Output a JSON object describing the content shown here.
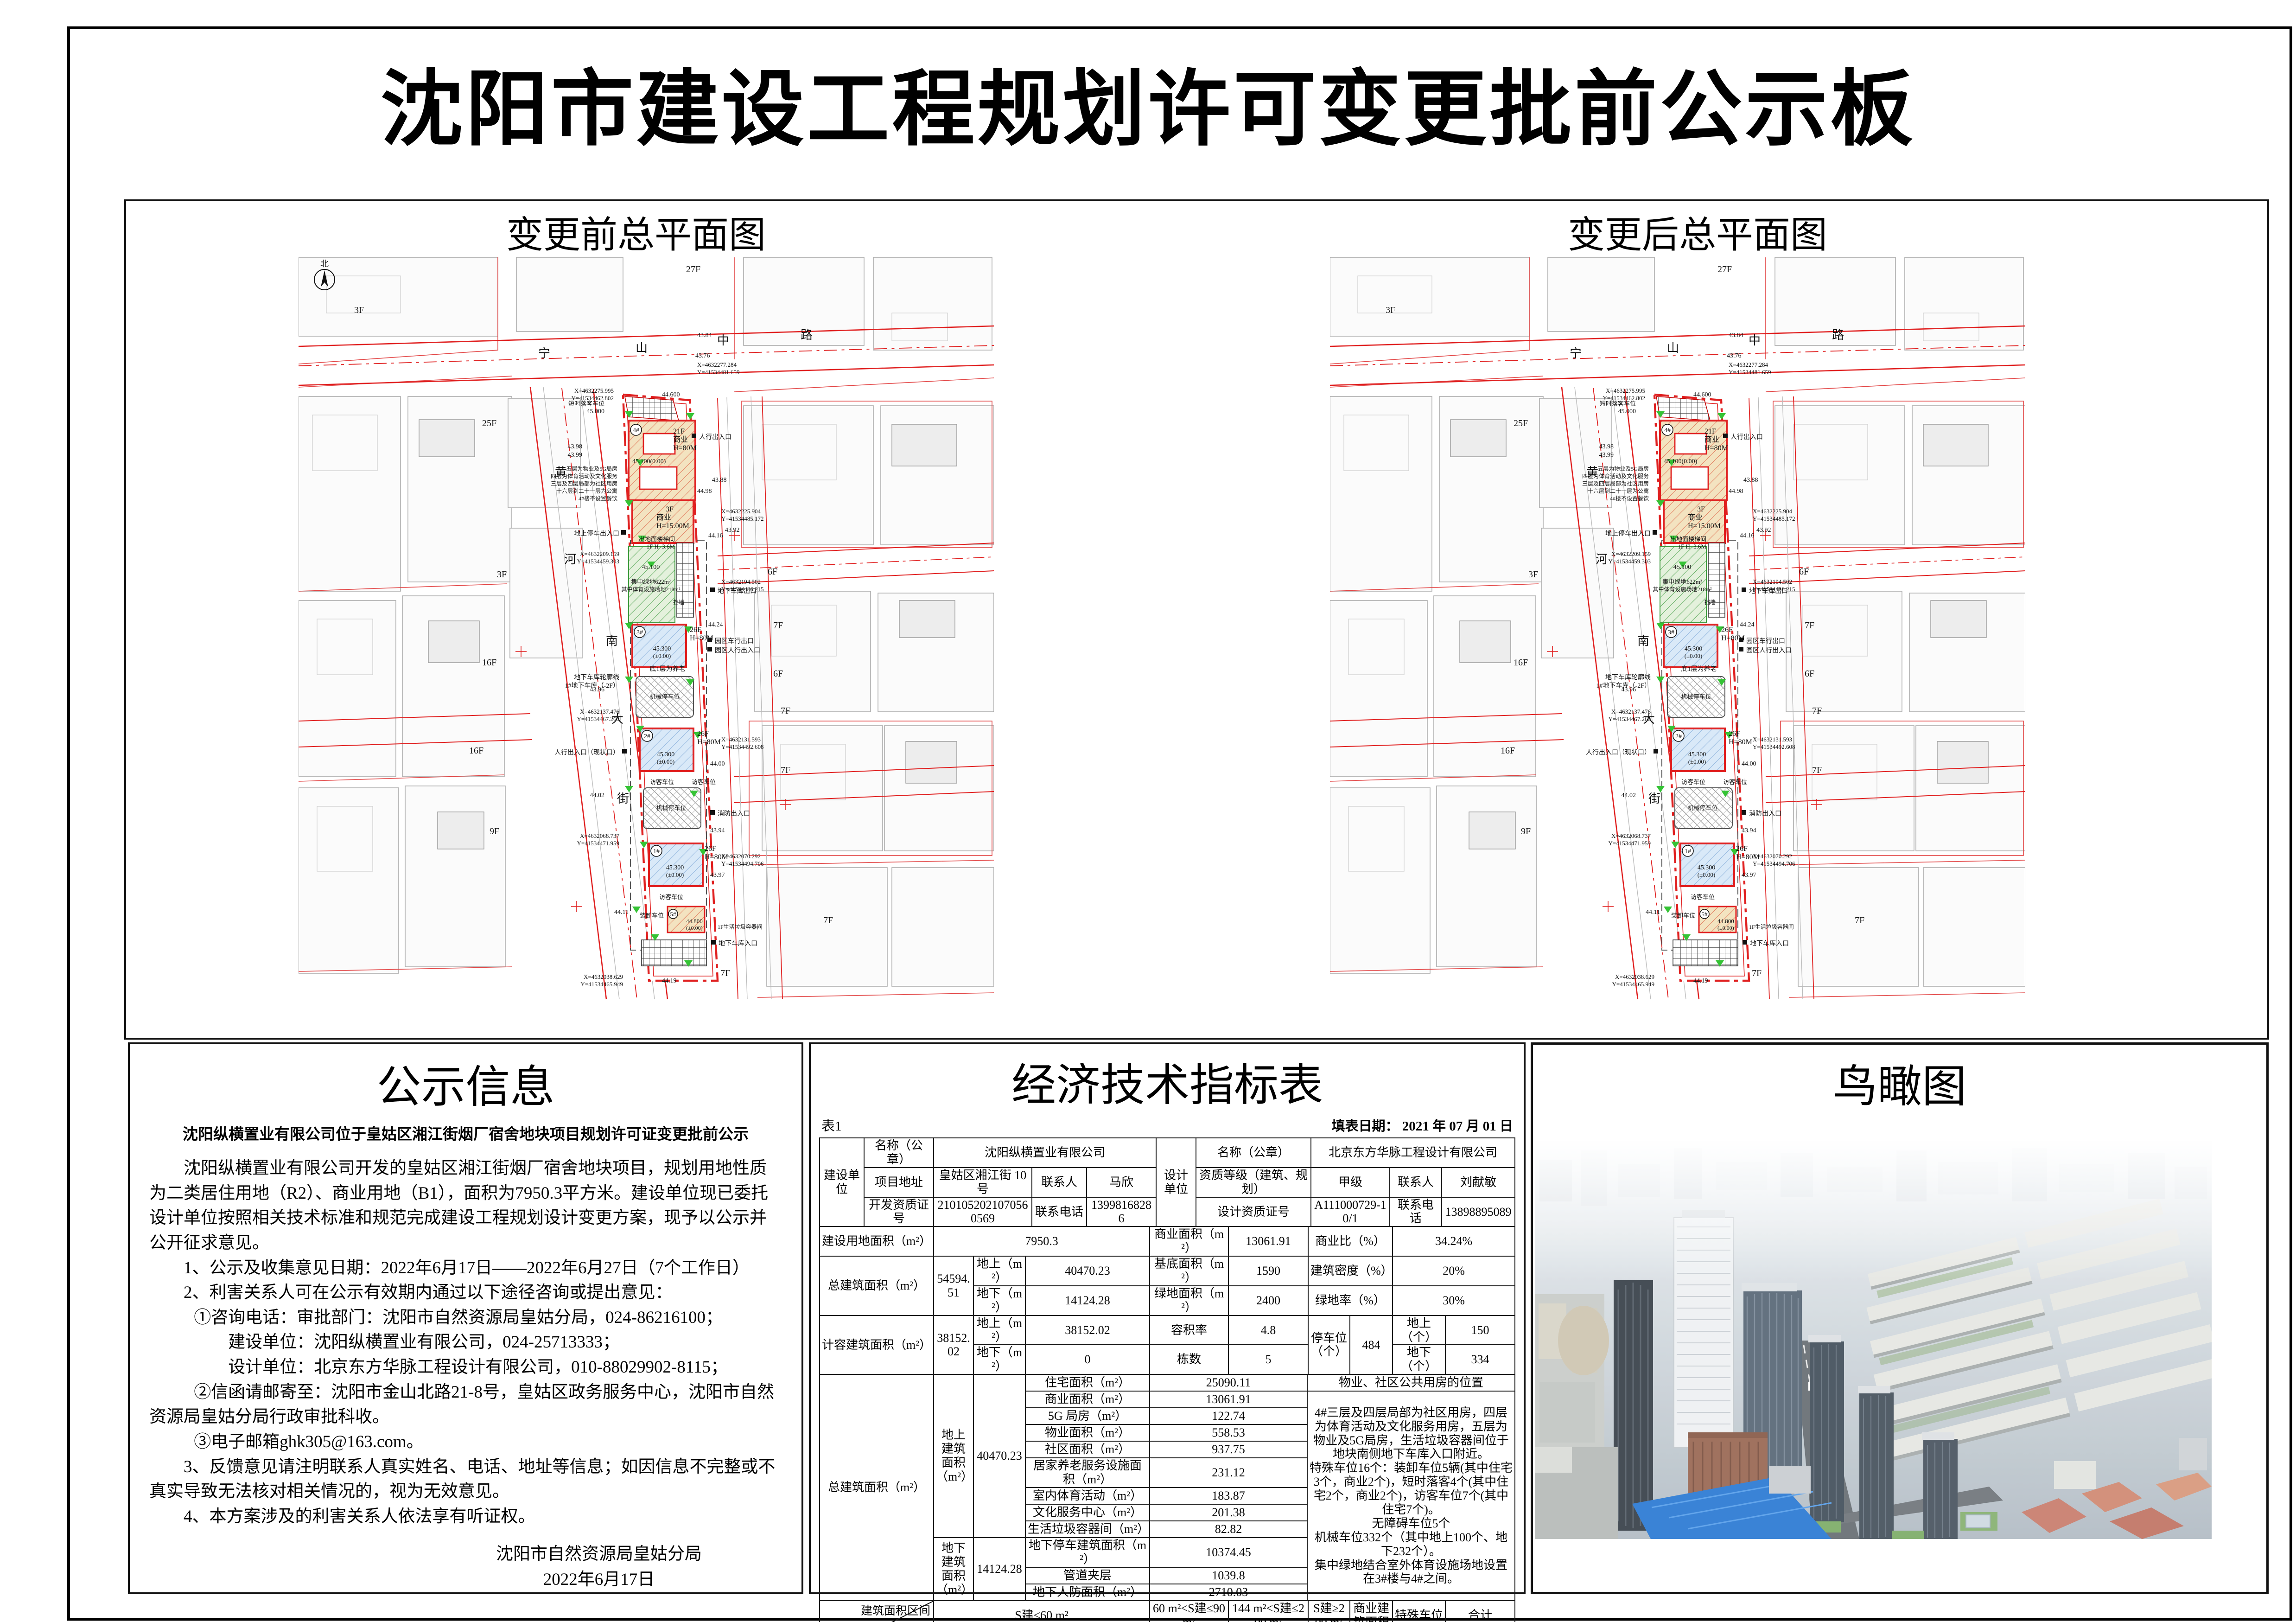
{
  "page": {
    "title": "沈阳市建设工程规划许可变更批前公示板"
  },
  "colors": {
    "boundary_red": "#e02020",
    "parcel_gray": "#adadad",
    "green_marker": "#35c335",
    "commercial_tan": "#f3e3c0",
    "residential_blue": "#d9e9f8",
    "greenspace": "#e4f1dc"
  },
  "plan": {
    "before_label": "变更前总平面图",
    "after_label": "变更后总平面图",
    "north": "北",
    "street_top": [
      "宁",
      "山",
      "中",
      "路"
    ],
    "street_left": [
      "黄",
      "河",
      "南",
      "大",
      "街"
    ],
    "floors": {
      "f27": "27F",
      "f25": "25F",
      "f3": "3F",
      "f16": "16F",
      "f9": "9F",
      "f6": "6F",
      "f7": "7F"
    },
    "b4_no": "4#",
    "b4_l1": "21F",
    "b4_l2": "商业",
    "b4_l3": "H=80M",
    "b4_lvl": "45.100(0.00)",
    "b3f_l1": "3F",
    "b3f_l2": "商业",
    "b3f_l3": "H=15.00M",
    "stair": "出地面楼梯间",
    "stair2": "1F H=3.6M",
    "green1": "集中绿地622m²",
    "green2": "其中体育设施场地218m²",
    "wall": "挡墙",
    "t3_no": "3#",
    "t2_no": "2#",
    "t1_no": "1#",
    "b5_no": "5#",
    "t26": "26F",
    "h80": "H=80M",
    "lvl453": "45.300",
    "pm0": "(±0.00)",
    "elder": "底1层为养老",
    "b5_lvl": "44.800",
    "b5_use": "1F生活垃圾容器间",
    "park": "机械停车位",
    "visitor": "访客车位",
    "drop": "短时落客车位",
    "unload": "装卸车位",
    "ped": "人行出入口",
    "ped2": "人行出入口（现状口）",
    "car_out": "地下车库出口",
    "car_in": "地下车库入口",
    "gate_car": "园区车行出口",
    "gate_ped": "园区人行出入口",
    "fire": "消防出入口",
    "ground_park": "地上停车出入口",
    "ug1": "地下车库轮廓线",
    "ug2": "1#地下车库（-2F）",
    "notes": [
      "五层为物业及5G局房",
      "四层为体育活动及文化服务",
      "三层及四层局部为社区用房",
      "十六层到二十一层为公寓",
      "4#楼不设置餐饮"
    ],
    "coords": [
      "X=4632275.995",
      "Y=41534462.802",
      "X=4632277.284",
      "Y=41534481.659",
      "X=4632225.904",
      "Y=41534485.172",
      "X=4632209.159",
      "Y=41534459.303",
      "X=4632194.502",
      "Y=41534486.215",
      "X=4632137.476",
      "Y=41534467.260",
      "X=4632131.593",
      "Y=41534492.608",
      "X=4632068.737",
      "Y=41534471.959",
      "X=4632070.292",
      "Y=41534494.706",
      "X=4632038.629",
      "Y=41534465.949"
    ],
    "elevs": [
      "44.600",
      "45.000",
      "43.98",
      "43.88",
      "44.98",
      "44.16",
      "45.100",
      "44.24",
      "43.96",
      "45.300",
      "44.00",
      "44.02",
      "43.94",
      "43.97",
      "44.11",
      "44.19",
      "43.84",
      "43.76",
      "43.92",
      "43.99"
    ]
  },
  "notice": {
    "title": "公示信息",
    "subtitle": "沈阳纵横置业有限公司位于皇姑区湘江街烟厂宿舍地块项目规划许可证变更批前公示",
    "para1": "沈阳纵横置业有限公司开发的皇姑区湘江街烟厂宿舍地块项目，规划用地性质为二类居住用地（R2）、商业用地（B1），面积为7950.3平方米。建设单位现已委托设计单位按照相关技术标准和规范完成建设工程规划设计变更方案，现予以公示并公开征求意见。",
    "item1": "1、公示及收集意见日期：2022年6月17日——2022年6月27日（7个工作日）",
    "item2": "2、利害关系人可在公示有效期内通过以下途径咨询或提出意见：",
    "item2a": "①咨询电话：审批部门：沈阳市自然资源局皇姑分局，024-86216100；",
    "item2b": "建设单位：沈阳纵横置业有限公司，024-25713333；",
    "item2c": "设计单位：北京东方华脉工程设计有限公司，010-88029902-8115；",
    "item2d": "②信函请邮寄至：沈阳市金山北路21-8号，皇姑区政务服务中心，沈阳市自然资源局皇姑分局行政审批科收。",
    "item2e": "③电子邮箱ghk305@163.com。",
    "item3": "3、反馈意见请注明联系人真实姓名、电话、地址等信息；如因信息不完整或不真实导致无法核对相关情况的，视为无效意见。",
    "item4": "4、本方案涉及的利害关系人依法享有听证权。",
    "sign1": "沈阳市自然资源局皇姑分局",
    "sign2": "2022年6月17日"
  },
  "table": {
    "title": "经济技术指标表",
    "tag": "表1",
    "date_label": "填表日期：  2021 年 07 月 01 日",
    "builder": {
      "role": "建设单位",
      "name_label": "名称（公章）",
      "name": "沈阳纵横置业有限公司",
      "addr_label": "项目地址",
      "addr": "皇姑区湘江街 10 号",
      "contact_label": "联系人",
      "contact": "马欣",
      "cert_label": "开发资质证号",
      "cert": "2101052021070560569",
      "phone_label": "联系电话",
      "phone": "13998168286"
    },
    "designer": {
      "role": "设计单位",
      "name_label": "名称（公章）",
      "name": "北京东方华脉工程设计有限公司",
      "grade_label": "资质等级（建筑、规划）",
      "grade": "甲级",
      "contact_label": "联系人",
      "contact": "刘献敏",
      "cert_label": "设计资质证号",
      "cert": "A111000729-10/1",
      "phone_label": "联系电话",
      "phone": "13898895089"
    },
    "metrics": {
      "land_label": "建设用地面积（m²）",
      "land": "7950.3",
      "biz_label": "商业面积（m²）",
      "biz": "13061.91",
      "bizratio_label": "商业比（%）",
      "bizratio": "34.24%",
      "total_label": "总建筑面积（m²）",
      "total": "54594.51",
      "above_label": "地上（m²）",
      "above": "40470.23",
      "base_label": "基底面积（m²）",
      "base": "1590",
      "density_label": "建筑密度（%）",
      "density": "20%",
      "below_label": "地下（m²）",
      "below": "14124.28",
      "green_label": "绿地面积（m²）",
      "green": "2400",
      "greenratio_label": "绿地率（%）",
      "greenratio": "30%",
      "cap_label": "计容建筑面积（m²）",
      "cap": "38152.02",
      "cap_above": "38152.02",
      "cap_below": "0",
      "far_label": "容积率",
      "far": "4.8",
      "blocks_label": "栋数",
      "blocks": "5",
      "park_label": "停车位（个）",
      "park": "484",
      "parkabove_label": "地上（个）",
      "parkabove": "150",
      "parkbelow_label": "地下（个）",
      "parkbelow": "334"
    },
    "breakdown": {
      "total_label": "总建筑面积（m²）",
      "above_group": "地上建筑面积（m²）",
      "above_total": "40470.23",
      "items_above": [
        [
          "住宅面积（m²）",
          "25090.11"
        ],
        [
          "商业面积（m²）",
          "13061.91"
        ],
        [
          "5G 局房（m²）",
          "122.74"
        ],
        [
          "物业面积（m²）",
          "558.53"
        ],
        [
          "社区面积（m²）",
          "937.75"
        ],
        [
          "居家养老服务设施面积（m²）",
          "231.12"
        ],
        [
          "室内体育活动（m²）",
          "183.87"
        ],
        [
          "文化服务中心（m²）",
          "201.38"
        ],
        [
          "生活垃圾容器间（m²）",
          "82.82"
        ]
      ],
      "below_group": "地下建筑面积（m²）",
      "below_total": "14124.28",
      "items_below": [
        [
          "地下停车建筑面积（m²）",
          "10374.45"
        ],
        [
          "管道夹层",
          "1039.8"
        ],
        [
          "地下人防面积（m²）",
          "2710.03"
        ]
      ],
      "note_header": "物业、社区公共用房的位置",
      "note": "4#三层及四层局部为社区用房，四层为体育活动及文化服务用房，五层为物业及5G局房，生活垃圾容器间位于地块南侧地下车库入口附近。\n特殊车位16个：装卸车位5辆(其中住宅3个，商业2个)，短时落客4个(其中住宅2个，商业2个)，访客车位7个(其中住宅7个)。\n无障碍车位5个\n机械车位332个（其中地上100个、地下232个）。\n集中绿地结合室外体育设施场地设置在3#楼与4#之间。"
    },
    "units": {
      "corner_top": "建筑面积区间",
      "corner_bottom": "住宅户数",
      "cols": [
        "S建≤60 m²",
        "60 m²<S建≤90 m²",
        "144 m²<S建≤200 m²",
        "S建≥200 m²",
        "商业建筑面积",
        "特殊车位",
        "合计"
      ],
      "households": [
        "408",
        "104",
        "",
        "",
        "13061.91",
        "",
        "512"
      ],
      "parking_label": "配建停车位（个）",
      "parking": [
        "245",
        "84",
        "",
        "",
        "139",
        "16",
        "484"
      ]
    }
  },
  "bird": {
    "title": "鸟瞰图"
  }
}
